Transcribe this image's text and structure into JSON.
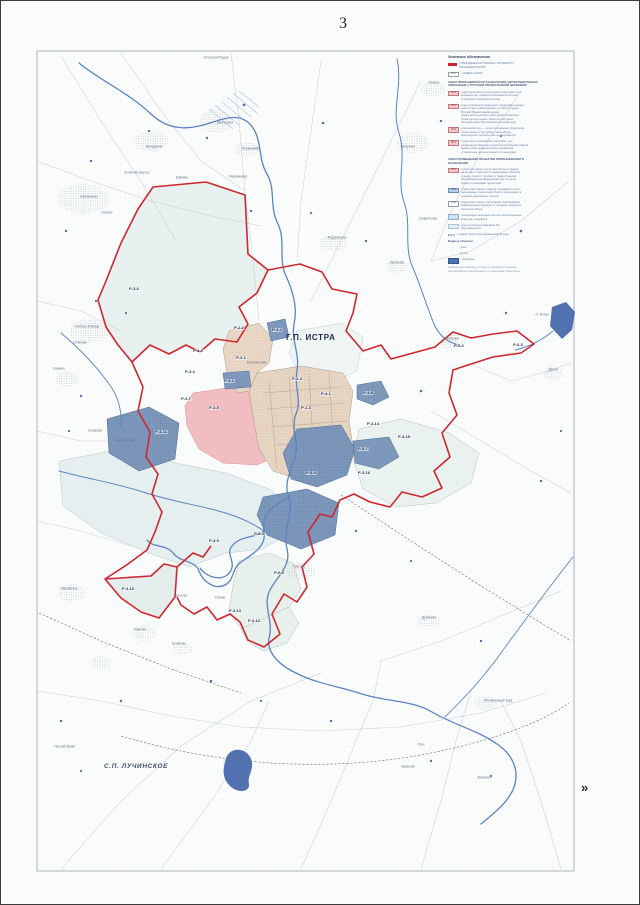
{
  "page": {
    "number": "3",
    "next_marker": "»"
  },
  "map": {
    "gp_title": "Г.П. ИСТРА",
    "sp_title": "С.П. ЛУЧИНСКОЕ",
    "zone_labels": [
      {
        "text": "Р-3-6",
        "x": 133,
        "y": 288
      },
      {
        "text": "Р-3-2",
        "x": 197,
        "y": 350
      },
      {
        "text": "Р-3-3",
        "x": 189,
        "y": 371
      },
      {
        "text": "Р-2-2",
        "x": 238,
        "y": 327
      },
      {
        "text": "Р-3-4",
        "x": 276,
        "y": 329
      },
      {
        "text": "Р-2-1",
        "x": 240,
        "y": 357
      },
      {
        "text": "Р-3-1",
        "x": 228,
        "y": 380
      },
      {
        "text": "Р-3-7",
        "x": 185,
        "y": 398
      },
      {
        "text": "Р-3-5",
        "x": 213,
        "y": 407
      },
      {
        "text": "Р-1-4",
        "x": 296,
        "y": 378
      },
      {
        "text": "Р-4-1",
        "x": 325,
        "y": 393
      },
      {
        "text": "Р-1-3",
        "x": 305,
        "y": 407
      },
      {
        "text": "Р-3-8",
        "x": 367,
        "y": 392
      },
      {
        "text": "Р-3-14",
        "x": 372,
        "y": 423
      },
      {
        "text": "Р-3-15",
        "x": 403,
        "y": 436
      },
      {
        "text": "Р-5-7",
        "x": 362,
        "y": 448
      },
      {
        "text": "Р-3-16",
        "x": 363,
        "y": 472
      },
      {
        "text": "Р-3-11",
        "x": 160,
        "y": 431
      },
      {
        "text": "Р-5-5",
        "x": 310,
        "y": 472
      },
      {
        "text": "Р-6-4",
        "x": 258,
        "y": 533
      },
      {
        "text": "Р-6-5",
        "x": 278,
        "y": 572
      },
      {
        "text": "Р-3-9",
        "x": 213,
        "y": 540
      },
      {
        "text": "Р-3-10",
        "x": 127,
        "y": 588
      },
      {
        "text": "Р-3-13",
        "x": 234,
        "y": 610
      },
      {
        "text": "Р-3-12",
        "x": 253,
        "y": 620
      },
      {
        "text": "Р-6-2",
        "x": 458,
        "y": 345
      },
      {
        "text": "Р-6-3",
        "x": 517,
        "y": 344
      }
    ],
    "place_labels": [
      {
        "text": "Устенская Рудня",
        "x": 215,
        "y": 57
      },
      {
        "text": "Исаево",
        "x": 433,
        "y": 82
      },
      {
        "text": "Никулино",
        "x": 407,
        "y": 146
      },
      {
        "text": "Дмитровка",
        "x": 224,
        "y": 122
      },
      {
        "text": "Мелединки",
        "x": 153,
        "y": 146
      },
      {
        "text": "Первомайка",
        "x": 250,
        "y": 148
      },
      {
        "text": "Максимовка",
        "x": 237,
        "y": 176
      },
      {
        "text": "Зелёный квартал",
        "x": 136,
        "y": 172
      },
      {
        "text": "Бабкино",
        "x": 181,
        "y": 177
      },
      {
        "text": "Ефимоново",
        "x": 88,
        "y": 196
      },
      {
        "text": "Носово",
        "x": 106,
        "y": 212
      },
      {
        "text": "Андреевское",
        "x": 336,
        "y": 237
      },
      {
        "text": "Крючково",
        "x": 396,
        "y": 262
      },
      {
        "text": "Сафонтьево",
        "x": 427,
        "y": 218
      },
      {
        "text": "Глебово-Избище",
        "x": 86,
        "y": 326
      },
      {
        "text": "Огниково",
        "x": 79,
        "y": 342
      },
      {
        "text": "Кашино",
        "x": 58,
        "y": 368
      },
      {
        "text": "Славково",
        "x": 94,
        "y": 430
      },
      {
        "text": "Комиссаровка",
        "x": 124,
        "y": 440
      },
      {
        "text": "Вельяминово",
        "x": 256,
        "y": 362
      },
      {
        "text": "Трусово",
        "x": 298,
        "y": 566
      },
      {
        "text": "Леоново",
        "x": 180,
        "y": 595
      },
      {
        "text": "Глинки",
        "x": 219,
        "y": 597
      },
      {
        "text": "Павловское",
        "x": 68,
        "y": 588
      },
      {
        "text": "Рожново",
        "x": 139,
        "y": 629
      },
      {
        "text": "Бунаково",
        "x": 178,
        "y": 643
      },
      {
        "text": "Качаброво",
        "x": 450,
        "y": 338
      },
      {
        "text": "Дарна",
        "x": 552,
        "y": 369
      },
      {
        "text": "ст. Истра",
        "x": 541,
        "y": 314
      },
      {
        "text": "Духанино",
        "x": 428,
        "y": 617
      },
      {
        "text": "Обновлённый Труд",
        "x": 497,
        "y": 700
      },
      {
        "text": "Роги",
        "x": 420,
        "y": 744
      },
      {
        "text": "Зыканово",
        "x": 407,
        "y": 766
      },
      {
        "text": "Жевнево",
        "x": 483,
        "y": 777
      },
      {
        "text": "Лесной Приют",
        "x": 64,
        "y": 746
      }
    ]
  },
  "legend": {
    "title": "Условные обозначения",
    "rows": [
      {
        "type": "item",
        "sym": "redline",
        "lines": [
          "УТВЕРЖДАЕМАЯ ГРАНИЦА ГОРОДСКОГО",
          "ПОСЕЛЕНИЯ ИСТРА"
        ]
      },
      {
        "type": "item",
        "sym": "plainchip",
        "chip": "Р-1",
        "lines": [
          "- ИНДЕКС ЗОНЫ"
        ]
      },
      {
        "type": "section",
        "lines": [
          "ЗОНЫ РЕКРЕАЦИОННОГО НАЗНАЧЕНИЯ, НЕПОСРЕДСТВЕННО",
          "СВЯЗАННЫЕ С РУССКОЙ ПРАВОСЛАВНОЙ ЦЕРКОВЬЮ"
        ]
      },
      {
        "type": "item",
        "sym": "pinkchip",
        "chip": "Р-3",
        "lines": [
          "территория объекта культурного наследия и его",
          "охранных зон, режим использования которых",
          "установлен законодательством"
        ]
      },
      {
        "type": "item",
        "sym": "pinkchip",
        "chip": "Р-3",
        "lines": [
          "зона охраняемого природного ландшафта долины",
          "реки Истры с размещением устройств отдыха",
          "Русской Православной церкви,",
          "режим использования территории установлен",
          "проектом зон охраны объекта культурного",
          "наследия Ново-Иерусалимского монастыря"
        ]
      },
      {
        "type": "item",
        "sym": "pinkchip",
        "chip": "Р-3",
        "lines": [
          "«Городской лес» — зона озеленённых территорий,",
          "прилегающих к застройке города Истры,",
          "капитальное строительство не допускается"
        ]
      },
      {
        "type": "item",
        "sym": "pinkchip",
        "chip": "Р-3",
        "lines": [
          "территория сложившейся застройки, для",
          "размещения объектов отдыха Русской Православной",
          "церкви, зоны рекреационного назначения",
          "установлены документацией по планировке"
        ]
      },
      {
        "type": "section",
        "lines": [
          "ЗОНЫ РАЗМЕЩЕНИЯ ОБЪЕКТОВ РЕКРЕАЦИОННОГО",
          "НАЗНАЧЕНИЯ"
        ]
      },
      {
        "type": "item",
        "sym": "pinkchip",
        "chip": "Р-3",
        "lines": [
          "территория вдоль русла реки Истры и прудов,",
          "на которых планируется размещение объектов",
          "отдыха, спорта и туризма, а также объектов",
          "обслуживания рекреационных зон согласно",
          "проекту планировки территории"
        ]
      },
      {
        "type": "item",
        "sym": "bluechip",
        "chip": "Р-3",
        "lines": [
          "территория парков, скверов, бульваров и иных",
          "озеленённых территорий общего пользования в",
          "границах населённых пунктов"
        ]
      },
      {
        "type": "item",
        "sym": "plainchip",
        "chip": "Р-3",
        "lines": [
          "территория лесов и лесопарков, выполняющих",
          "рекреационные функции, в границах городского",
          "поселения Истра"
        ]
      },
      {
        "type": "item",
        "sym": "swatch1",
        "lines": [
          "прибрежные защитные полосы и водоохранные",
          "зоны рек и водоёмов"
        ]
      },
      {
        "type": "item",
        "sym": "swatch2",
        "lines": [
          "зоны затопления паводком 1%",
          "обеспеченности"
        ]
      },
      {
        "type": "item",
        "chip": "Р-3-1",
        "lines": [
          "- индекс территории рекреационной зоны"
        ]
      },
      {
        "type": "subheader",
        "lines": [
          "Водные объекты:"
        ]
      },
      {
        "type": "item",
        "sym": "none",
        "lines": [
          "- реки"
        ]
      },
      {
        "type": "item",
        "sym": "none",
        "lines": [
          "- ручьи"
        ]
      },
      {
        "type": "item",
        "sym": "waterswatch",
        "lines": [
          "- водоёмы"
        ]
      },
      {
        "type": "footnote",
        "lines": [
          "Границы зон показаны условно и подлежат уточнению",
          "при разработке документации по планировке территории"
        ]
      }
    ]
  },
  "colors": {
    "boundary_red": "#cf2730",
    "water_blue": "#3f63a8",
    "zone_blue": "#7e98bb",
    "zone_pink": "#f2bdc1",
    "urban_tan": "#ecdac8",
    "forest_light": "#e9f1f0"
  }
}
